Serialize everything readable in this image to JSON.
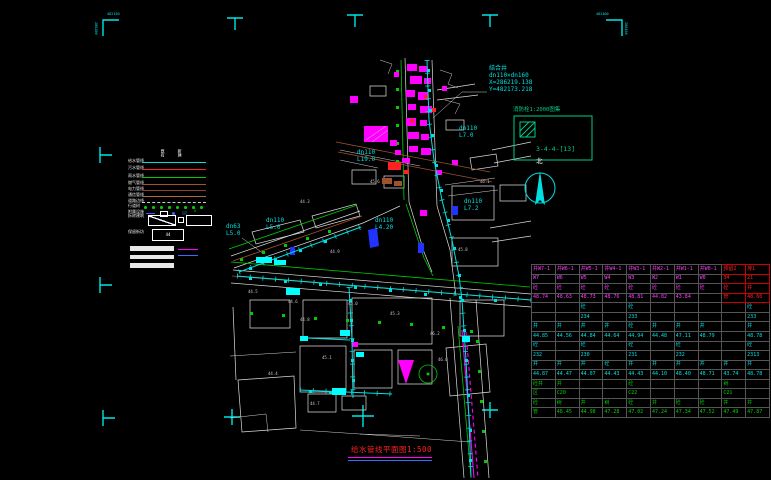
{
  "window": {
    "background": "#000000"
  },
  "colors": {
    "cyan": "#00e0e0",
    "bright_cyan": "#00ffff",
    "magenta": "#ff00ff",
    "green": "#00cc00",
    "red": "#ff2222",
    "brown": "#a0522d",
    "blue": "#2233ff",
    "white": "#dcdcdc",
    "teal": "#00cc88"
  },
  "title": {
    "text": "给水管线平面图1:500",
    "color": "#ff2222"
  },
  "north_label": "北",
  "detail_box": {
    "title": "消防栓1:2000图集",
    "ref": "3-4-4-[13]"
  },
  "corner_marks": {
    "top_left_h": "482150",
    "top_left_v": "286200",
    "top_right_h": "482400",
    "top_right_v": "286450"
  },
  "junction_note": "结合井\ndn110×dn160\nX=286219.138\nY=482173.218",
  "legend": {
    "col_headers": [
      "既有",
      "新建"
    ],
    "rows": [
      {
        "label": "给水管线",
        "color": "#00e0e0",
        "type": "line"
      },
      {
        "label": "污水管线",
        "color": "#ff2222",
        "type": "line"
      },
      {
        "label": "雨水管线",
        "color": "#00cc00",
        "type": "line"
      },
      {
        "label": "燃气管线",
        "color": "#a0522d",
        "type": "line"
      },
      {
        "label": "电力管线",
        "color": "#8b4030",
        "type": "line"
      },
      {
        "label": "通信管线",
        "color": "#b06a40",
        "type": "line"
      },
      {
        "label": "道路边线",
        "color": "#cccccc",
        "type": "dashed"
      },
      {
        "label": "行道树",
        "color": "#00cc00",
        "type": "dots"
      },
      {
        "label": "附属设施",
        "color": "#4455ff",
        "type": "symbols"
      }
    ],
    "boxes": [
      {
        "label": "拆除建筑",
        "type": "group"
      },
      {
        "label": "保留街坊",
        "type": "aa",
        "inner": "44"
      }
    ],
    "bars": 3,
    "extra_lines": [
      {
        "color": "#ff00ff"
      },
      {
        "color": "#3a6cff"
      }
    ]
  },
  "map_labels": [
    {
      "x": 489,
      "y": 66,
      "fs": 6,
      "c": "#00e0e0",
      "text": "结合井\ndn110×dn160\nX=286219.138\nY=482173.218"
    },
    {
      "x": 459,
      "y": 126,
      "fs": 6,
      "c": "#00e0e0",
      "text": "dn110\nL7.0"
    },
    {
      "x": 357,
      "y": 150,
      "fs": 6,
      "c": "#00e0e0",
      "text": "dn110\nL19.0"
    },
    {
      "x": 375,
      "y": 218,
      "fs": 6,
      "c": "#00e0e0",
      "text": "dn110\nL4.20"
    },
    {
      "x": 266,
      "y": 218,
      "fs": 6,
      "c": "#00e0e0",
      "text": "dn110\nL5.0"
    },
    {
      "x": 226,
      "y": 224,
      "fs": 6,
      "c": "#00e0e0",
      "text": "dn63\nL5.0"
    },
    {
      "x": 464,
      "y": 199,
      "fs": 6,
      "c": "#00e0e0",
      "text": "dn110\nL7.2"
    }
  ],
  "spot_elevations": [
    {
      "x": 300,
      "y": 318,
      "v": "44.8"
    },
    {
      "x": 322,
      "y": 356,
      "v": "45.1"
    },
    {
      "x": 288,
      "y": 300,
      "v": "44.6"
    },
    {
      "x": 430,
      "y": 332,
      "v": "46.2"
    },
    {
      "x": 348,
      "y": 302,
      "v": "45.0"
    },
    {
      "x": 248,
      "y": 290,
      "v": "44.5"
    },
    {
      "x": 458,
      "y": 248,
      "v": "45.8"
    },
    {
      "x": 330,
      "y": 250,
      "v": "44.9"
    },
    {
      "x": 390,
      "y": 312,
      "v": "45.3"
    },
    {
      "x": 310,
      "y": 402,
      "v": "44.7"
    },
    {
      "x": 268,
      "y": 372,
      "v": "44.4"
    },
    {
      "x": 438,
      "y": 358,
      "v": "46.0"
    },
    {
      "x": 370,
      "y": 180,
      "v": "45.6"
    },
    {
      "x": 300,
      "y": 200,
      "v": "44.3"
    },
    {
      "x": 480,
      "y": 180,
      "v": "46.1"
    }
  ],
  "table": {
    "sections": [
      {
        "id": "a",
        "red_cols": [
          8,
          9
        ],
        "rows": [
          [
            "井W7-1",
            "井W6-1",
            "井W5-1",
            "井W4-1",
            "井W3-1",
            "井W2-1",
            "井W1-1",
            "井W0-1",
            "预留2",
            "排1"
          ],
          [
            "W7",
            "W6",
            "W5",
            "W4",
            "W3",
            "W2",
            "W1",
            "W0",
            "34",
            "21"
          ],
          [
            "砼",
            "砼",
            "砼",
            "砼",
            "砼",
            "砼",
            "砼",
            "砼",
            "砼",
            "井"
          ],
          [
            "48.74",
            "48.63",
            "48.73",
            "48.76",
            "48.81",
            "44.82",
            "43.84",
            "",
            "管",
            "48.60"
          ]
        ]
      },
      {
        "id": "b",
        "rows": [
          [
            "",
            "",
            "砼",
            "",
            "砼",
            "",
            "",
            "",
            "",
            "砼"
          ],
          [
            "",
            "",
            "234",
            "",
            "233",
            "",
            "",
            "",
            "",
            "233"
          ],
          [
            "井",
            "井",
            "井",
            "井",
            "砼",
            "井",
            "井",
            "井",
            "",
            "井"
          ],
          [
            "44.85",
            "44.56",
            "44.84",
            "44.64",
            "44.94",
            "44.48",
            "47.11",
            "48.79",
            "",
            "48.78"
          ]
        ]
      },
      {
        "id": "c",
        "rows": [
          [
            "砼",
            "",
            "砼",
            "",
            "砼",
            "",
            "砼",
            "",
            "",
            "砼"
          ],
          [
            "232",
            "",
            "230",
            "",
            "231",
            "",
            "232",
            "",
            "",
            "2313"
          ],
          [
            "井",
            "井",
            "井",
            "砼",
            "井",
            "井",
            "井",
            "井",
            "井",
            "井"
          ],
          [
            "44.87",
            "44.47",
            "44.07",
            "44.43",
            "44.43",
            "44.10",
            "48.40",
            "48.71",
            "43.74",
            "48.78"
          ]
        ]
      },
      {
        "id": "d",
        "rows": [
          [
            "砼井",
            "井",
            "",
            "",
            "砼",
            "",
            "",
            "",
            "树",
            ""
          ],
          [
            "区",
            "C20",
            "",
            "",
            "C22",
            "",
            "",
            "",
            "C21",
            ""
          ],
          [
            "砼",
            "树",
            "井",
            "树",
            "砼",
            "井",
            "砼",
            "砼",
            "井",
            "井"
          ],
          [
            "管",
            "48.45",
            "44.98",
            "47.28",
            "47.02",
            "47.24",
            "47.34",
            "47.52",
            "47.49",
            "47.87"
          ]
        ]
      }
    ]
  }
}
